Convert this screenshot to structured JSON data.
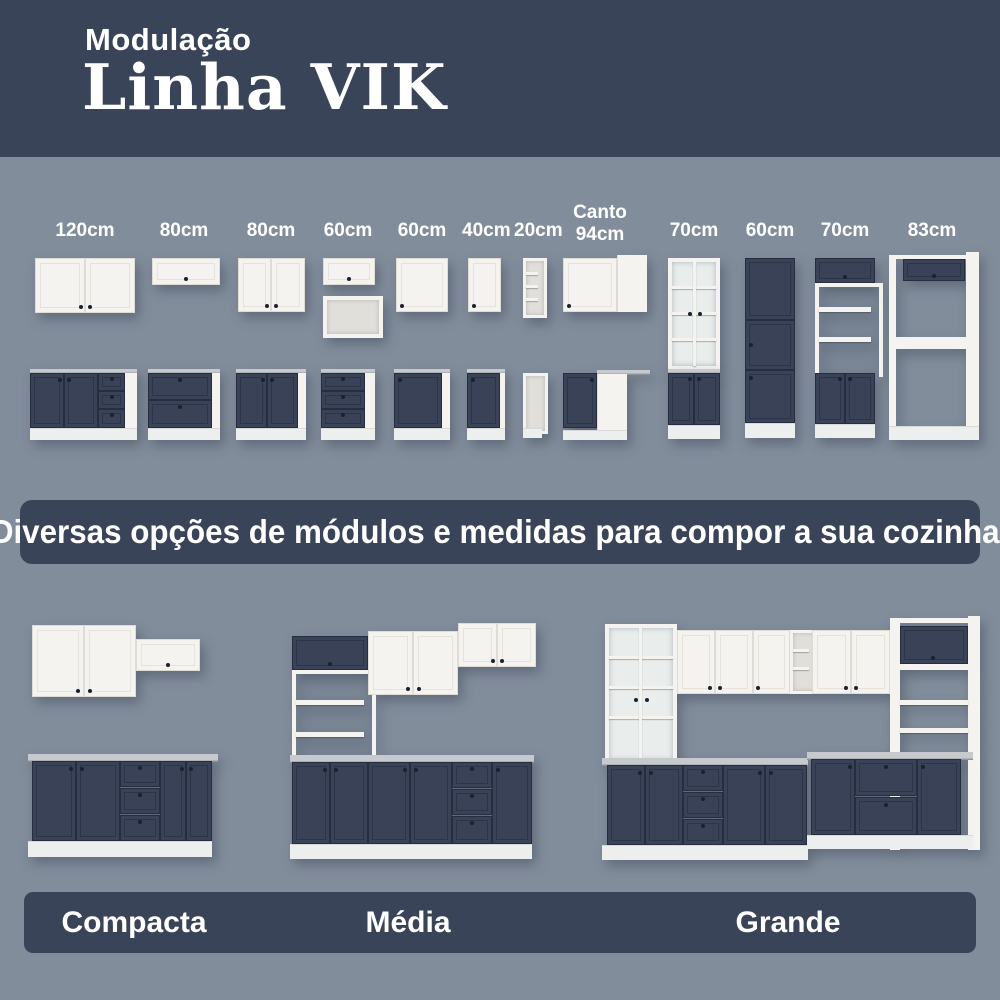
{
  "header": {
    "subtitle": "Modulação",
    "title": "Linha VIK"
  },
  "modules": {
    "items": [
      {
        "label": "120cm"
      },
      {
        "label": "80cm"
      },
      {
        "label": "80cm"
      },
      {
        "label": "60cm"
      },
      {
        "label": "60cm"
      },
      {
        "label": "40cm"
      },
      {
        "label": "20cm"
      },
      {
        "label": "Canto",
        "label2": "94cm"
      },
      {
        "label": "70cm"
      },
      {
        "label": "60cm"
      },
      {
        "label": "70cm"
      },
      {
        "label": "83cm"
      }
    ]
  },
  "banner": {
    "text": "Diversas opções de módulos e medidas para compor a sua cozinha!"
  },
  "kitchens": {
    "items": [
      {
        "name": "Compacta"
      },
      {
        "name": "Média"
      },
      {
        "name": "Grande"
      }
    ]
  },
  "colors": {
    "navy_band": "#3a4458",
    "page_background": "#828d9c",
    "cabinet_white": "#f4f3ef",
    "cabinet_navy": "#3a4258",
    "countertop_gray": "#c6c9cd",
    "text_white": "#ffffff"
  }
}
